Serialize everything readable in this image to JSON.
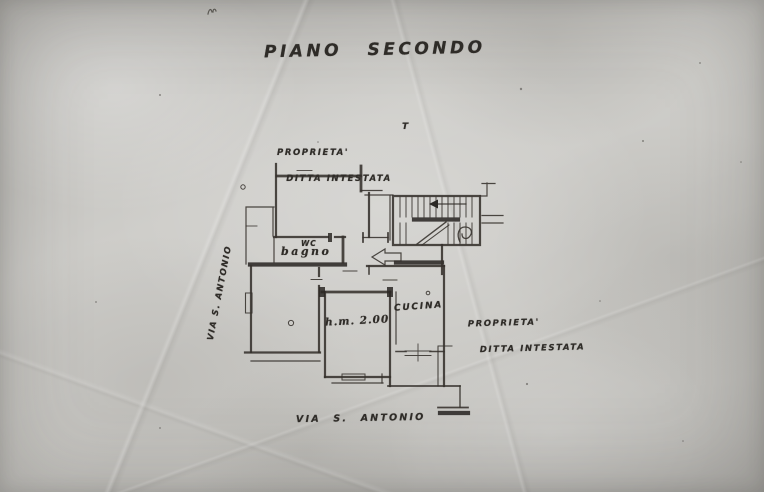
{
  "document": {
    "type": "scanned floor plan",
    "title": "PIANO SECONDO",
    "colors": {
      "paper": "#cbcac6",
      "ink": "#2f2c28"
    },
    "floor_plan": {
      "street_label_left": "VIA S. ANTONIO",
      "street_label_bottom": "VIA S. ANTONIO",
      "property_label_top": {
        "line1": "PROPRIETA'",
        "line2": "DITTA INTESTATA"
      },
      "property_label_right": {
        "line1": "PROPRIETA'",
        "line2": "DITTA INTESTATA"
      },
      "stair_mark": "T",
      "rooms": {
        "wc": "WC",
        "bagno": "bagno",
        "camera_note": "h.m. 2.00",
        "cucina": "CUCINA"
      }
    }
  }
}
